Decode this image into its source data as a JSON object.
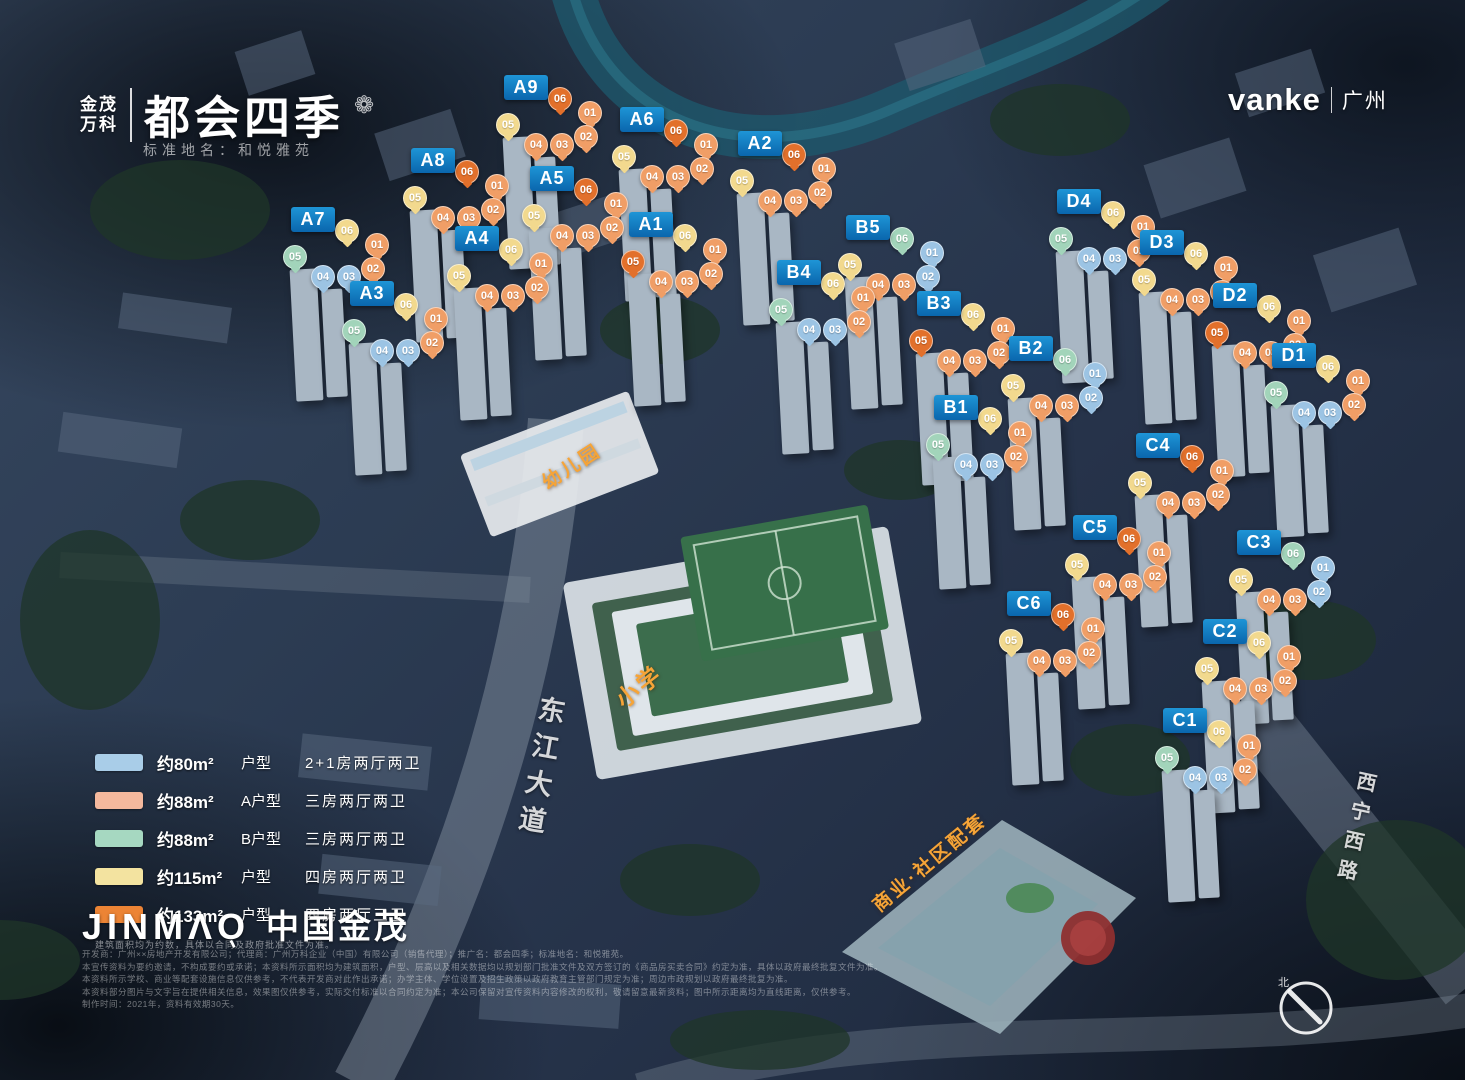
{
  "header": {
    "brand_left_line1": "金茂",
    "brand_left_line2": "万科",
    "brand_title": "都会四季",
    "emblem_icon": "flower-emblem",
    "subtitle": "标准地名：和悦雅苑",
    "brand_right": "vanke",
    "brand_right_region": "广州"
  },
  "unit_types": {
    "80": {
      "name": "约80m² 户型",
      "badge": "#9cc4e4",
      "swatch": "#a9cde8"
    },
    "88A": {
      "name": "约88m² A户型",
      "badge": "#f09e66",
      "swatch": "#f4b89d"
    },
    "88B": {
      "name": "约88m² B户型",
      "badge": "#a2d4ba",
      "swatch": "#a6d8c1"
    },
    "115": {
      "name": "约115m² 户型",
      "badge": "#f2d98e",
      "swatch": "#f3e3a0"
    },
    "133": {
      "name": "约133m² 户型",
      "badge": "#e2702b",
      "swatch": "#ec8435"
    }
  },
  "legend": {
    "rows": [
      {
        "type": "80",
        "area": "约80m²",
        "type_label": "户型",
        "layout": "2+1房两厅两卫"
      },
      {
        "type": "88A",
        "area": "约88m²",
        "type_label": "A户型",
        "layout": "三房两厅两卫"
      },
      {
        "type": "88B",
        "area": "约88m²",
        "type_label": "B户型",
        "layout": "三房两厅两卫"
      },
      {
        "type": "115",
        "area": "约115m²",
        "type_label": "户型",
        "layout": "四房两厅两卫"
      },
      {
        "type": "133",
        "area": "约133m²",
        "type_label": "户型",
        "layout": "四房两厅三卫"
      }
    ],
    "note": "建筑面积均为约数，具体以合同及政府批准文件为准。"
  },
  "buildings": [
    {
      "id": "A9",
      "x": 504,
      "y": 75,
      "badges": [
        [
          "06",
          "133"
        ],
        [
          "01",
          "88A"
        ],
        [
          "02",
          "88A"
        ],
        [
          "05",
          "115"
        ],
        [
          "04",
          "88A"
        ],
        [
          "03",
          "88A"
        ]
      ]
    },
    {
      "id": "A6",
      "x": 620,
      "y": 107,
      "badges": [
        [
          "06",
          "133"
        ],
        [
          "01",
          "88A"
        ],
        [
          "02",
          "88A"
        ],
        [
          "05",
          "115"
        ],
        [
          "04",
          "88A"
        ],
        [
          "03",
          "88A"
        ]
      ]
    },
    {
      "id": "A2",
      "x": 738,
      "y": 131,
      "badges": [
        [
          "06",
          "133"
        ],
        [
          "01",
          "88A"
        ],
        [
          "02",
          "88A"
        ],
        [
          "05",
          "115"
        ],
        [
          "04",
          "88A"
        ],
        [
          "03",
          "88A"
        ]
      ]
    },
    {
      "id": "A8",
      "x": 411,
      "y": 148,
      "badges": [
        [
          "06",
          "133"
        ],
        [
          "01",
          "88A"
        ],
        [
          "02",
          "88A"
        ],
        [
          "05",
          "115"
        ],
        [
          "04",
          "88A"
        ],
        [
          "03",
          "88A"
        ]
      ]
    },
    {
      "id": "A5",
      "x": 530,
      "y": 166,
      "badges": [
        [
          "06",
          "133"
        ],
        [
          "01",
          "88A"
        ],
        [
          "02",
          "88A"
        ],
        [
          "05",
          "115"
        ],
        [
          "04",
          "88A"
        ],
        [
          "03",
          "88A"
        ]
      ]
    },
    {
      "id": "A7",
      "x": 291,
      "y": 207,
      "badges": [
        [
          "06",
          "115"
        ],
        [
          "01",
          "88A"
        ],
        [
          "02",
          "88A"
        ],
        [
          "05",
          "88B"
        ],
        [
          "04",
          "80"
        ],
        [
          "03",
          "80"
        ]
      ]
    },
    {
      "id": "A4",
      "x": 455,
      "y": 226,
      "badges": [
        [
          "06",
          "115"
        ],
        [
          "01",
          "88A"
        ],
        [
          "02",
          "88A"
        ],
        [
          "05",
          "115"
        ],
        [
          "04",
          "88A"
        ],
        [
          "03",
          "88A"
        ]
      ]
    },
    {
      "id": "A1",
      "x": 629,
      "y": 212,
      "badges": [
        [
          "06",
          "115"
        ],
        [
          "01",
          "88A"
        ],
        [
          "02",
          "88A"
        ],
        [
          "05",
          "133"
        ],
        [
          "04",
          "88A"
        ],
        [
          "03",
          "88A"
        ]
      ]
    },
    {
      "id": "A3",
      "x": 350,
      "y": 281,
      "badges": [
        [
          "06",
          "115"
        ],
        [
          "01",
          "88A"
        ],
        [
          "02",
          "88A"
        ],
        [
          "05",
          "88B"
        ],
        [
          "04",
          "80"
        ],
        [
          "03",
          "80"
        ]
      ]
    },
    {
      "id": "B5",
      "x": 846,
      "y": 215,
      "badges": [
        [
          "06",
          "88B"
        ],
        [
          "01",
          "80"
        ],
        [
          "02",
          "80"
        ],
        [
          "05",
          "115"
        ],
        [
          "04",
          "88A"
        ],
        [
          "03",
          "88A"
        ]
      ]
    },
    {
      "id": "B4",
      "x": 777,
      "y": 260,
      "badges": [
        [
          "06",
          "115"
        ],
        [
          "01",
          "88A"
        ],
        [
          "02",
          "88A"
        ],
        [
          "05",
          "88B"
        ],
        [
          "04",
          "80"
        ],
        [
          "03",
          "80"
        ]
      ]
    },
    {
      "id": "B3",
      "x": 917,
      "y": 291,
      "badges": [
        [
          "06",
          "115"
        ],
        [
          "01",
          "88A"
        ],
        [
          "02",
          "88A"
        ],
        [
          "05",
          "133"
        ],
        [
          "04",
          "88A"
        ],
        [
          "03",
          "88A"
        ]
      ]
    },
    {
      "id": "B2",
      "x": 1009,
      "y": 336,
      "badges": [
        [
          "06",
          "88B"
        ],
        [
          "01",
          "80"
        ],
        [
          "02",
          "80"
        ],
        [
          "05",
          "115"
        ],
        [
          "04",
          "88A"
        ],
        [
          "03",
          "88A"
        ]
      ]
    },
    {
      "id": "B1",
      "x": 934,
      "y": 395,
      "badges": [
        [
          "06",
          "115"
        ],
        [
          "01",
          "88A"
        ],
        [
          "02",
          "88A"
        ],
        [
          "05",
          "88B"
        ],
        [
          "04",
          "80"
        ],
        [
          "03",
          "80"
        ]
      ]
    },
    {
      "id": "D4",
      "x": 1057,
      "y": 189,
      "badges": [
        [
          "06",
          "115"
        ],
        [
          "01",
          "88A"
        ],
        [
          "02",
          "88A"
        ],
        [
          "05",
          "88B"
        ],
        [
          "04",
          "80"
        ],
        [
          "03",
          "80"
        ]
      ]
    },
    {
      "id": "D3",
      "x": 1140,
      "y": 230,
      "badges": [
        [
          "06",
          "115"
        ],
        [
          "01",
          "88A"
        ],
        [
          "02",
          "88A"
        ],
        [
          "05",
          "115"
        ],
        [
          "04",
          "88A"
        ],
        [
          "03",
          "88A"
        ]
      ]
    },
    {
      "id": "D2",
      "x": 1213,
      "y": 283,
      "badges": [
        [
          "06",
          "115"
        ],
        [
          "01",
          "88A"
        ],
        [
          "02",
          "88A"
        ],
        [
          "05",
          "133"
        ],
        [
          "04",
          "88A"
        ],
        [
          "03",
          "88A"
        ]
      ]
    },
    {
      "id": "D1",
      "x": 1272,
      "y": 343,
      "badges": [
        [
          "06",
          "115"
        ],
        [
          "01",
          "88A"
        ],
        [
          "02",
          "88A"
        ],
        [
          "05",
          "88B"
        ],
        [
          "04",
          "80"
        ],
        [
          "03",
          "80"
        ]
      ]
    },
    {
      "id": "C4",
      "x": 1136,
      "y": 433,
      "badges": [
        [
          "06",
          "133"
        ],
        [
          "01",
          "88A"
        ],
        [
          "02",
          "88A"
        ],
        [
          "05",
          "115"
        ],
        [
          "04",
          "88A"
        ],
        [
          "03",
          "88A"
        ]
      ]
    },
    {
      "id": "C5",
      "x": 1073,
      "y": 515,
      "badges": [
        [
          "06",
          "133"
        ],
        [
          "01",
          "88A"
        ],
        [
          "02",
          "88A"
        ],
        [
          "05",
          "115"
        ],
        [
          "04",
          "88A"
        ],
        [
          "03",
          "88A"
        ]
      ]
    },
    {
      "id": "C3",
      "x": 1237,
      "y": 530,
      "badges": [
        [
          "06",
          "88B"
        ],
        [
          "01",
          "80"
        ],
        [
          "02",
          "80"
        ],
        [
          "05",
          "115"
        ],
        [
          "04",
          "88A"
        ],
        [
          "03",
          "88A"
        ]
      ]
    },
    {
      "id": "C6",
      "x": 1007,
      "y": 591,
      "badges": [
        [
          "06",
          "133"
        ],
        [
          "01",
          "88A"
        ],
        [
          "02",
          "88A"
        ],
        [
          "05",
          "115"
        ],
        [
          "04",
          "88A"
        ],
        [
          "03",
          "88A"
        ]
      ]
    },
    {
      "id": "C2",
      "x": 1203,
      "y": 619,
      "badges": [
        [
          "06",
          "115"
        ],
        [
          "01",
          "88A"
        ],
        [
          "02",
          "88A"
        ],
        [
          "05",
          "115"
        ],
        [
          "04",
          "88A"
        ],
        [
          "03",
          "88A"
        ]
      ]
    },
    {
      "id": "C1",
      "x": 1163,
      "y": 708,
      "badges": [
        [
          "06",
          "115"
        ],
        [
          "01",
          "88A"
        ],
        [
          "02",
          "88A"
        ],
        [
          "05",
          "88B"
        ],
        [
          "04",
          "80"
        ],
        [
          "03",
          "80"
        ]
      ]
    }
  ],
  "facilities": [
    {
      "label": "幼儿园",
      "x": 538,
      "y": 452,
      "rot": -33,
      "size": 19
    },
    {
      "label": "小学",
      "x": 612,
      "y": 668,
      "rot": -38,
      "size": 23
    },
    {
      "label": "商业·社区配套",
      "x": 858,
      "y": 848,
      "rot": -40,
      "size": 19
    }
  ],
  "roads": [
    {
      "label": "东江大道",
      "x": 520,
      "y": 695,
      "rot": 10,
      "size": 27
    },
    {
      "label": "西宁西路",
      "x": 1340,
      "y": 770,
      "rot": 12,
      "size": 20
    }
  ],
  "footer": {
    "logo_en": "JINMΛO",
    "logo_cn": "中国金茂",
    "disclaimer_lines": [
      "开发商：广州××房地产开发有限公司；代理商：广州万科企业（中国）有限公司（销售代理）；推广名：都会四季；标准地名：和悦雅苑。",
      "本宣传资料为要约邀请，不构成要约或承诺；本资料所示面积均为建筑面积，户型、层高以及相关数据均以规划部门批准文件及双方签订的《商品房买卖合同》约定为准，具体以政府最终批复文件为准。",
      "本资料所示学校、商业等配套设施信息仅供参考，不代表开发商对此作出承诺；办学主体、学位设置及招生政策以政府教育主管部门规定为准；周边市政规划以政府最终批复为准。",
      "本资料部分图片与文字旨在提供相关信息，效果图仅供参考，实际交付标准以合同约定为准；本公司保留对宣传资料内容修改的权利，敬请留意最新资料；图中所示距离均为直线距离，仅供参考。",
      "制作时间：2021年，资料有效期30天。"
    ]
  },
  "compass": {
    "label": "北"
  }
}
